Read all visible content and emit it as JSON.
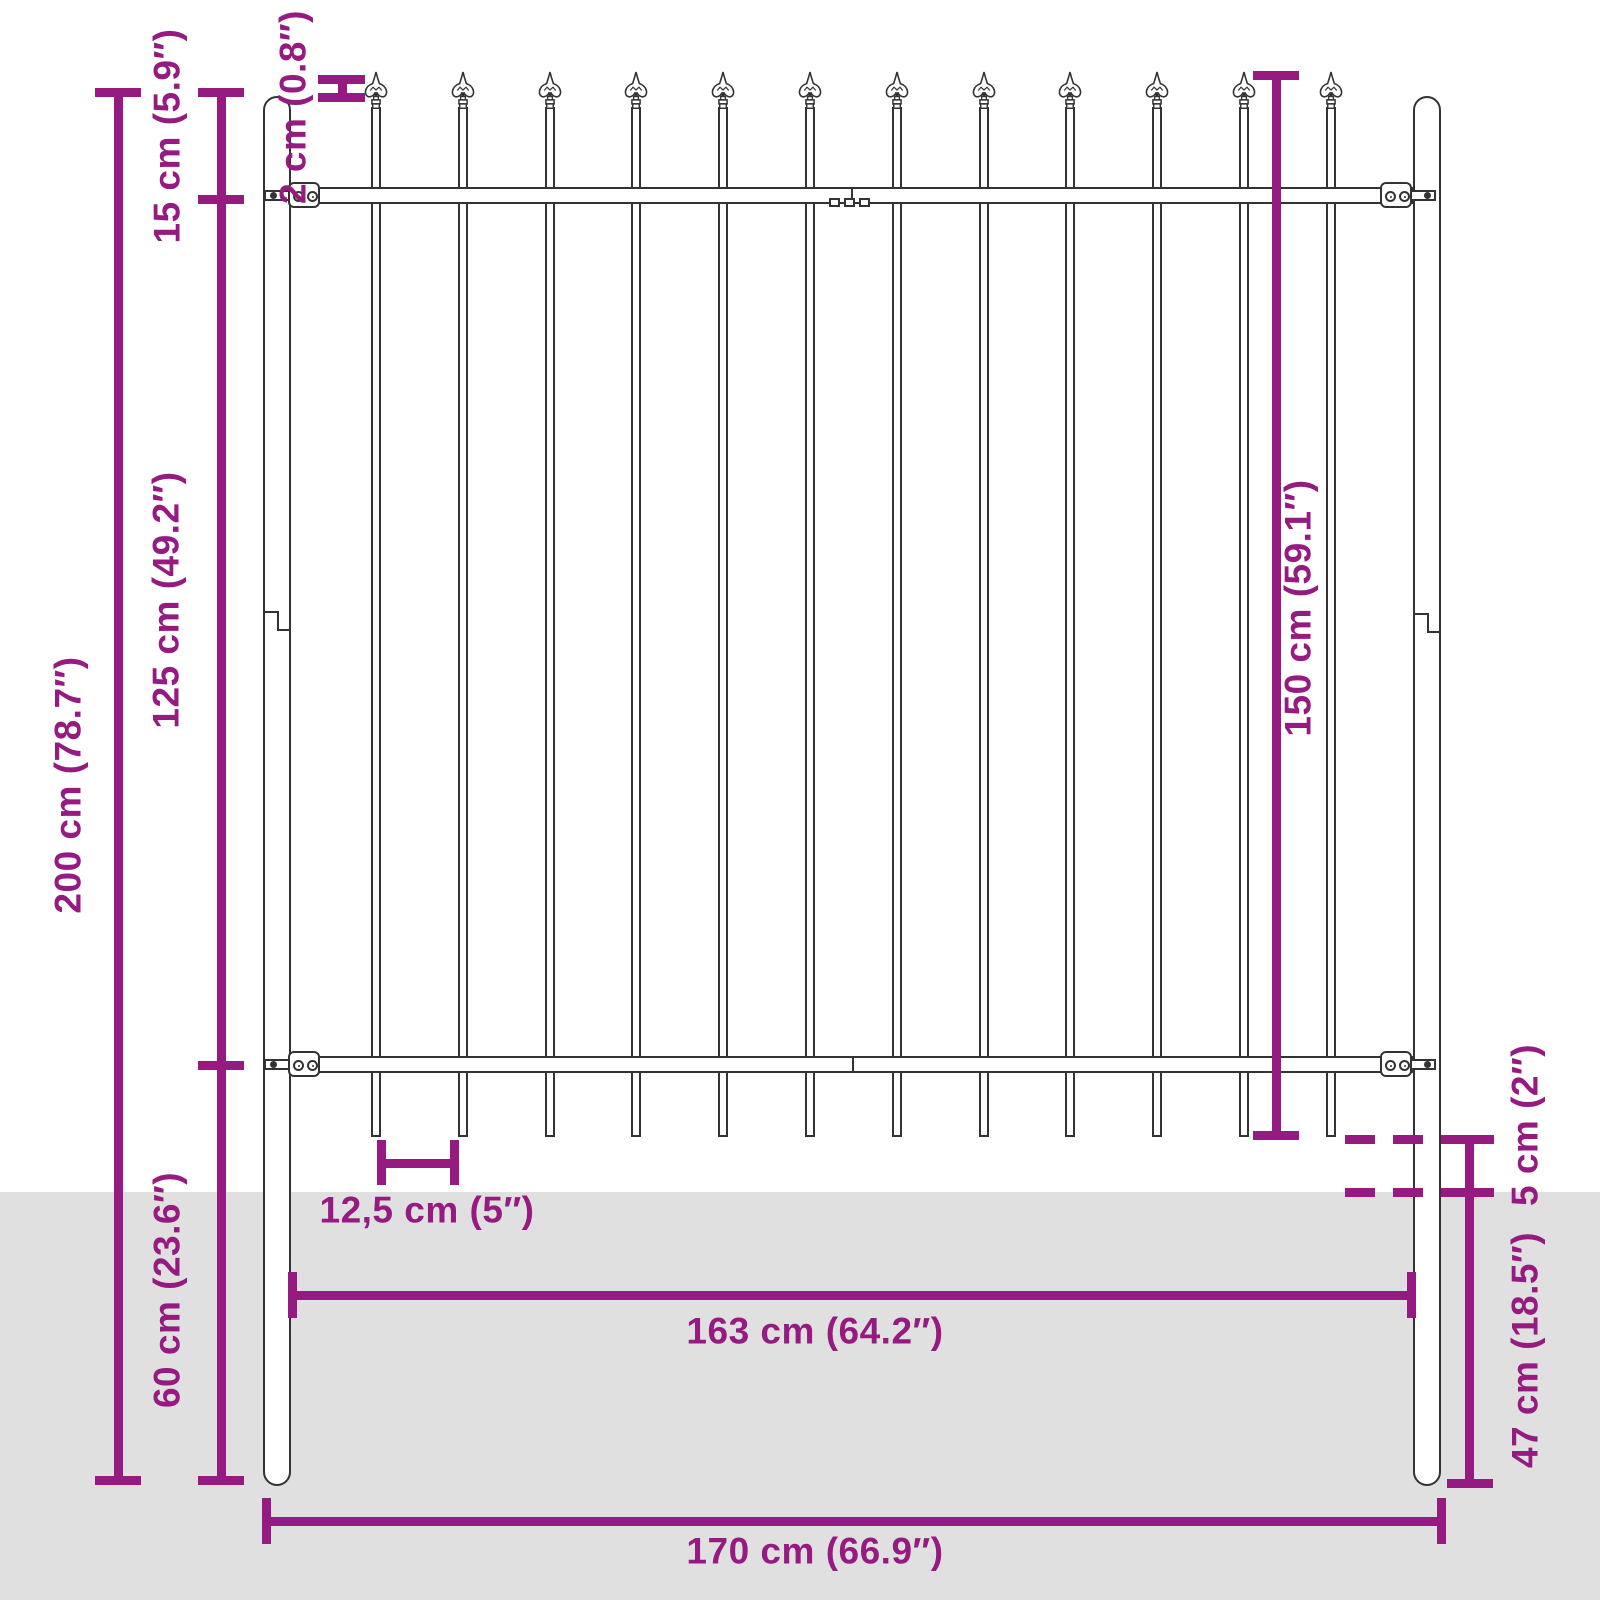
{
  "diagram": {
    "title": "Fence panel with spear top - dimension drawing",
    "colors": {
      "accent": "#951b81",
      "ground": "#e0e0e0",
      "line": "#333333",
      "fill": "#ffffff"
    },
    "fence": {
      "picket_count": 12,
      "finial_style": "spear-fleur-de-lis"
    },
    "labels": {
      "total_height": "200 cm (78.7″)",
      "spear_section_height": "15 cm (5.9″)",
      "mid_section_height": "125 cm (49.2″)",
      "below_rail_depth": "60 cm (23.6″)",
      "picket_top_offset": "2 cm (0.8″)",
      "panel_height": "150 cm (59.1″)",
      "picket_gap": "12,5 cm (5″)",
      "ground_clearance": "5 cm (2″)",
      "post_underground_depth": "47 cm (18.5″)",
      "inner_width": "163 cm (64.2″)",
      "outer_width": "170 cm (66.9″)"
    }
  }
}
